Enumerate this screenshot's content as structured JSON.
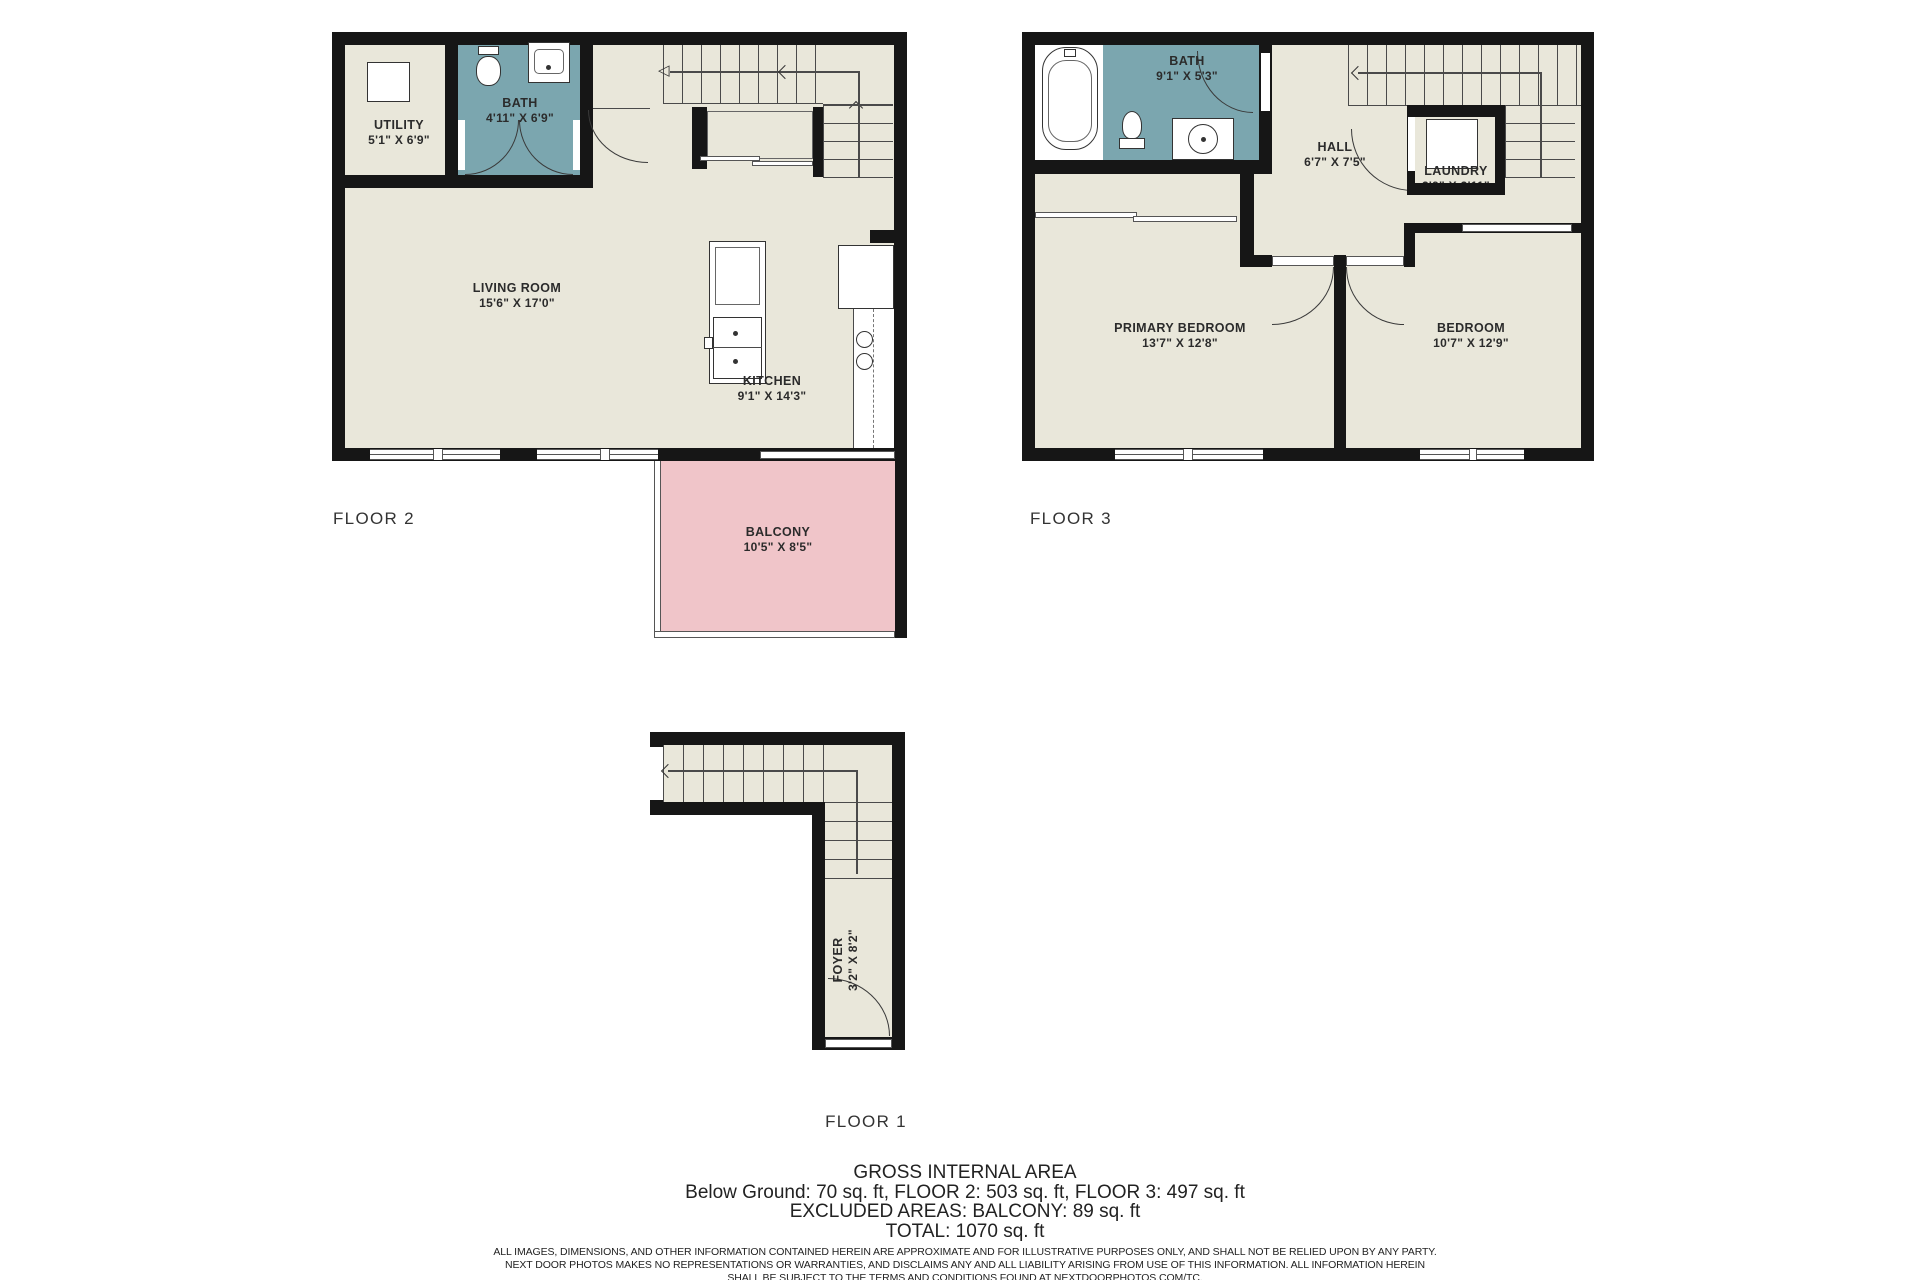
{
  "colors": {
    "floor_fill": "#e9e7da",
    "bath_fill": "#7ba6af",
    "balcony_fill": "#f0c5c9",
    "wall": "#161616"
  },
  "floors": {
    "floor2": {
      "label": "FLOOR 2",
      "rooms": {
        "utility": {
          "name": "UTILITY",
          "dims": "5'1\" X 6'9\""
        },
        "bath": {
          "name": "BATH",
          "dims": "4'11\" X 6'9\""
        },
        "living": {
          "name": "LIVING ROOM",
          "dims": "15'6\" X 17'0\""
        },
        "kitchen": {
          "name": "KITCHEN",
          "dims": "9'1\" X 14'3\""
        },
        "balcony": {
          "name": "BALCONY",
          "dims": "10'5\" X 8'5\""
        }
      }
    },
    "floor3": {
      "label": "FLOOR 3",
      "rooms": {
        "bath": {
          "name": "BATH",
          "dims": "9'1\" X 5'3\""
        },
        "hall": {
          "name": "HALL",
          "dims": "6'7\" X 7'5\""
        },
        "laundry": {
          "name": "LAUNDRY",
          "dims": "3'9\" X 3'11\""
        },
        "primary_bedroom": {
          "name": "PRIMARY BEDROOM",
          "dims": "13'7\" X 12'8\""
        },
        "bedroom": {
          "name": "BEDROOM",
          "dims": "10'7\" X 12'9\""
        }
      }
    },
    "floor1": {
      "label": "FLOOR 1",
      "rooms": {
        "foyer": {
          "name": "FOYER",
          "dims": "3'2\" X 8'2\""
        }
      }
    }
  },
  "footer": {
    "title": "GROSS INTERNAL AREA",
    "area_line": "Below Ground: 70 sq. ft, FLOOR 2: 503 sq. ft, FLOOR 3: 497 sq. ft",
    "excluded_line": "EXCLUDED AREAS: BALCONY: 89 sq. ft",
    "total_line": "TOTAL: 1070 sq. ft",
    "disclaimer_1": "ALL IMAGES, DIMENSIONS, AND OTHER INFORMATION CONTAINED HEREIN ARE APPROXIMATE AND FOR ILLUSTRATIVE PURPOSES ONLY, AND SHALL NOT BE RELIED UPON BY ANY PARTY.",
    "disclaimer_2": "NEXT DOOR PHOTOS MAKES NO REPRESENTATIONS OR WARRANTIES, AND DISCLAIMS ANY AND ALL LIABILITY ARISING FROM USE OF THIS INFORMATION. ALL INFORMATION HEREIN",
    "disclaimer_3": "SHALL BE SUBJECT TO THE TERMS AND CONDITIONS FOUND AT NEXTDOORPHOTOS.COM/TC."
  }
}
